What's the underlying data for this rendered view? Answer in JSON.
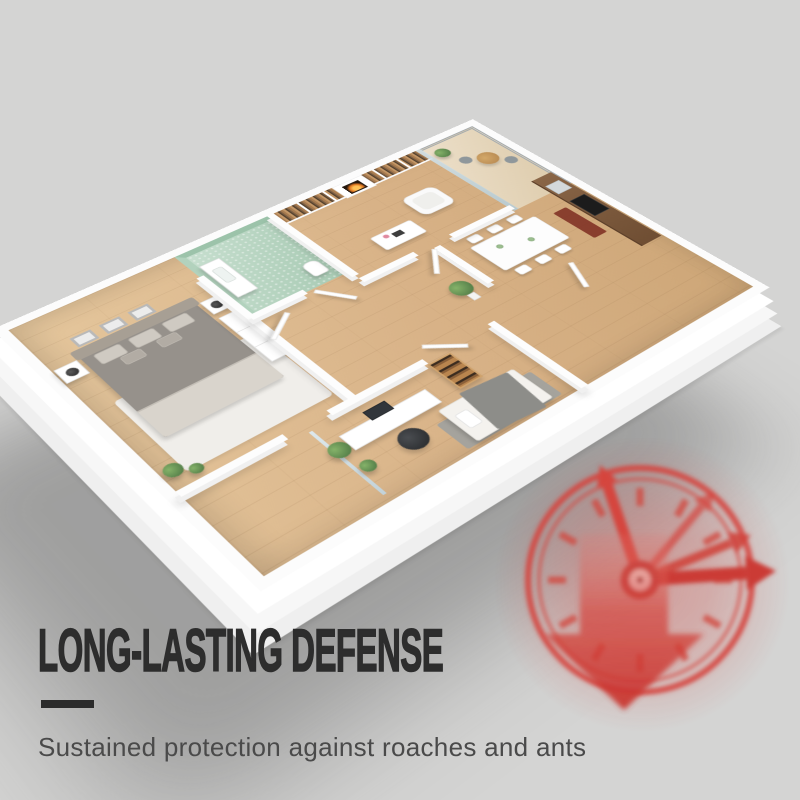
{
  "background_color": "#d4d4d3",
  "headline": {
    "text": "LONG-LASTING DEFENSE",
    "color": "#2d2d2d"
  },
  "divider": {
    "color": "#2b2b2b"
  },
  "subheadline": {
    "text": "Sustained protection against roaches and ants",
    "color": "#4a4a4a"
  },
  "artwork": {
    "floorplan": {
      "type": "3d-isometric-apartment-cutaway-render",
      "wall_color": "#fcfcfc",
      "wood_floor_color": "#d8b287",
      "bathroom_tile_color": "#b9d5c2",
      "rooms": [
        "master-bedroom",
        "bathroom",
        "living-room",
        "balcony",
        "kitchen-dining",
        "hallway",
        "office-bedroom"
      ],
      "furniture": [
        "double-bed",
        "nightstands",
        "lamps",
        "wall-frames",
        "wardrobe",
        "vanity-sink",
        "toilet",
        "bookshelves",
        "fireplace",
        "armchair",
        "coffee-table",
        "window",
        "dining-table",
        "chairs",
        "kitchen-counter",
        "stove",
        "balcony-table",
        "balcony-chairs",
        "desk",
        "computer-monitor",
        "office-chair",
        "book-rack",
        "single-bed",
        "potted-plants",
        "open-doors"
      ]
    },
    "clock_badge": {
      "icons": [
        "clock-icon",
        "down-arrow-icon"
      ],
      "color": "#cf3b35"
    }
  }
}
